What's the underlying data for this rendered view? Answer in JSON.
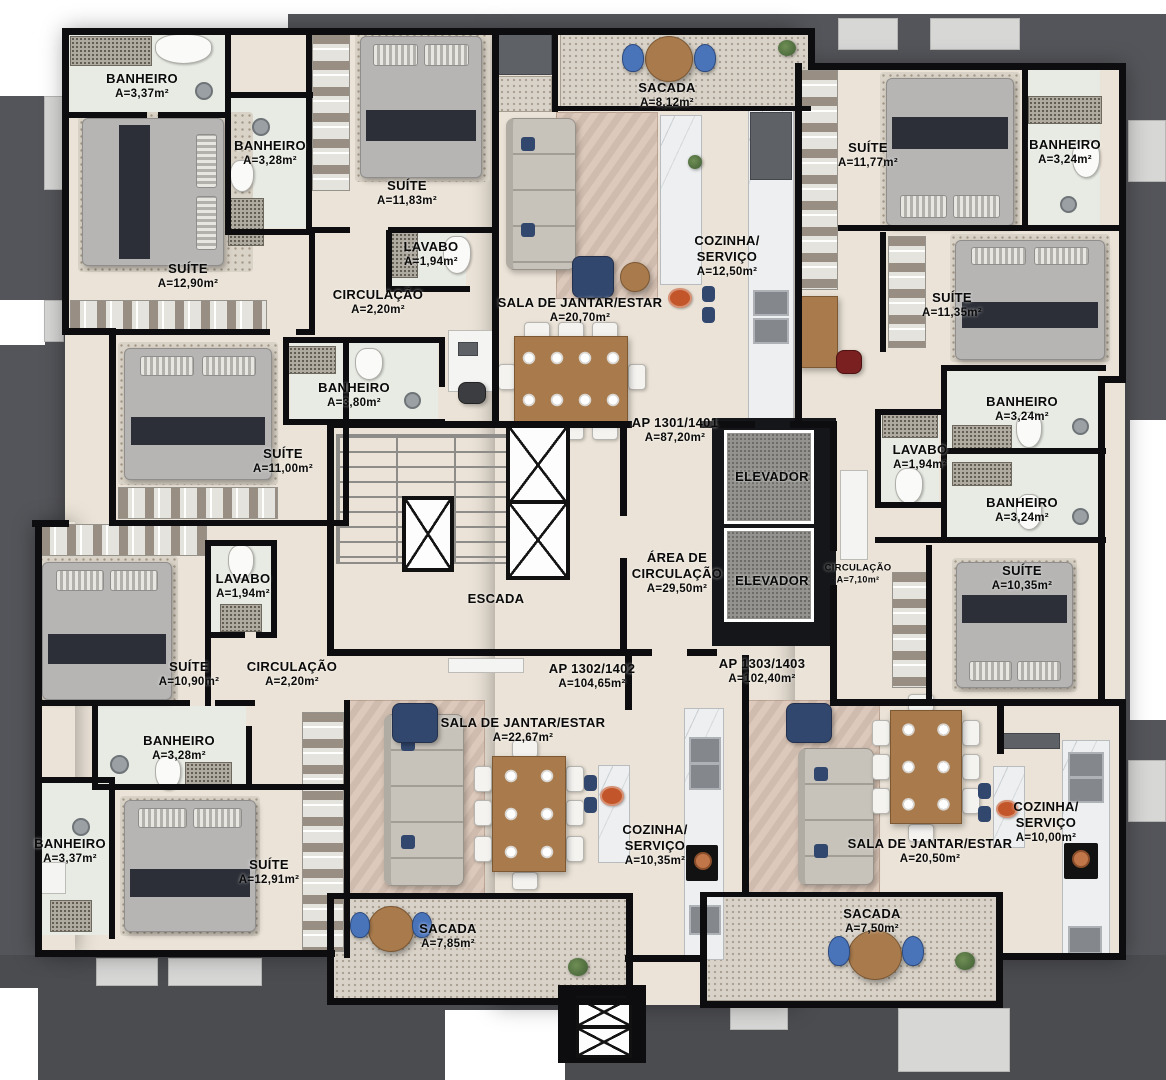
{
  "figure": {
    "kind": "residential-floor-plan",
    "colors": {
      "wall": "#0d0d0f",
      "floor": "#ebe3d7",
      "exterior": "#54555a",
      "balcony_floor": "#d8d2c8",
      "accent_blue": "#4a74ba",
      "navy": "#32476e",
      "wood": "#a87a4c",
      "marble": "#edeff0",
      "label_text": "#0a0a0a"
    },
    "units": [
      {
        "id": "AP 1301/1401",
        "area": "A=87,20m²"
      },
      {
        "id": "AP 1302/1402",
        "area": "A=104,65m²"
      },
      {
        "id": "AP 1303/1403",
        "area": "A=102,40m²"
      }
    ],
    "plan_labels": [
      {
        "name": "BANHEIRO",
        "area": "A=3,37m²",
        "x": 142,
        "y": 86
      },
      {
        "name": "BANHEIRO",
        "area": "A=3,28m²",
        "x": 270,
        "y": 153
      },
      {
        "name": "SUÍTE",
        "area": "A=11,83m²",
        "x": 407,
        "y": 193
      },
      {
        "name": "LAVABO",
        "area": "A=1,94m²",
        "x": 431,
        "y": 254
      },
      {
        "name": "SUÍTE",
        "area": "A=12,90m²",
        "x": 188,
        "y": 276
      },
      {
        "name": "CIRCULAÇÃO",
        "area": "A=2,20m²",
        "x": 378,
        "y": 302
      },
      {
        "name": "SALA DE JANTAR/ESTAR",
        "area": "A=20,70m²",
        "x": 580,
        "y": 310
      },
      {
        "name": "SACADA",
        "area": "A=8,12m²",
        "x": 667,
        "y": 95
      },
      {
        "name": "COZINHA/\nSERVIÇO",
        "area": "A=12,50m²",
        "x": 727,
        "y": 256
      },
      {
        "name": "SUÍTE",
        "area": "A=11,77m²",
        "x": 868,
        "y": 155
      },
      {
        "name": "BANHEIRO",
        "area": "A=3,24m²",
        "x": 1065,
        "y": 152
      },
      {
        "name": "SUÍTE",
        "area": "A=11,35m²",
        "x": 952,
        "y": 305
      },
      {
        "name": "BANHEIRO",
        "area": "A=3,80m²",
        "x": 354,
        "y": 395
      },
      {
        "name": "SUÍTE",
        "area": "A=11,00m²",
        "x": 283,
        "y": 461
      },
      {
        "name": "AP 1301/1401",
        "area": "A=87,20m²",
        "x": 675,
        "y": 430
      },
      {
        "name": "ELEVADOR",
        "area": "",
        "x": 772,
        "y": 477
      },
      {
        "name": "ELEVADOR",
        "area": "",
        "x": 772,
        "y": 581
      },
      {
        "name": "BANHEIRO",
        "area": "A=3,24m²",
        "x": 1022,
        "y": 409
      },
      {
        "name": "LAVABO",
        "area": "A=1,94m²",
        "x": 920,
        "y": 457
      },
      {
        "name": "BANHEIRO",
        "area": "A=3,24m²",
        "x": 1022,
        "y": 510
      },
      {
        "name": "CIRCULAÇÃO",
        "area": "A=7,10m²",
        "x": 858,
        "y": 574,
        "size": "sm"
      },
      {
        "name": "SUÍTE",
        "area": "A=10,35m²",
        "x": 1022,
        "y": 578
      },
      {
        "name": "ESCADA",
        "area": "",
        "x": 496,
        "y": 599
      },
      {
        "name": "ÁREA DE\nCIRCULAÇÃO",
        "area": "A=29,50m²",
        "x": 677,
        "y": 573
      },
      {
        "name": "LAVABO",
        "area": "A=1,94m²",
        "x": 243,
        "y": 586
      },
      {
        "name": "SUÍTE",
        "area": "A=10,90m²",
        "x": 189,
        "y": 674
      },
      {
        "name": "CIRCULAÇÃO",
        "area": "A=2,20m²",
        "x": 292,
        "y": 674
      },
      {
        "name": "AP 1302/1402",
        "area": "A=104,65m²",
        "x": 592,
        "y": 676
      },
      {
        "name": "AP 1303/1403",
        "area": "A=102,40m²",
        "x": 762,
        "y": 671
      },
      {
        "name": "SALA DE JANTAR/ESTAR",
        "area": "A=22,67m²",
        "x": 523,
        "y": 730
      },
      {
        "name": "BANHEIRO",
        "area": "A=3,28m²",
        "x": 179,
        "y": 748
      },
      {
        "name": "BANHEIRO",
        "area": "A=3,37m²",
        "x": 70,
        "y": 851
      },
      {
        "name": "SUÍTE",
        "area": "A=12,91m²",
        "x": 269,
        "y": 872
      },
      {
        "name": "COZINHA/\nSERVIÇO",
        "area": "A=10,35m²",
        "x": 655,
        "y": 845
      },
      {
        "name": "SALA DE JANTAR/ESTAR",
        "area": "A=20,50m²",
        "x": 930,
        "y": 851
      },
      {
        "name": "COZINHA/\nSERVIÇO",
        "area": "A=10,00m²",
        "x": 1046,
        "y": 822
      },
      {
        "name": "SACADA",
        "area": "A=7,85m²",
        "x": 448,
        "y": 936
      },
      {
        "name": "SACADA",
        "area": "A=7,50m²",
        "x": 872,
        "y": 921
      }
    ]
  }
}
